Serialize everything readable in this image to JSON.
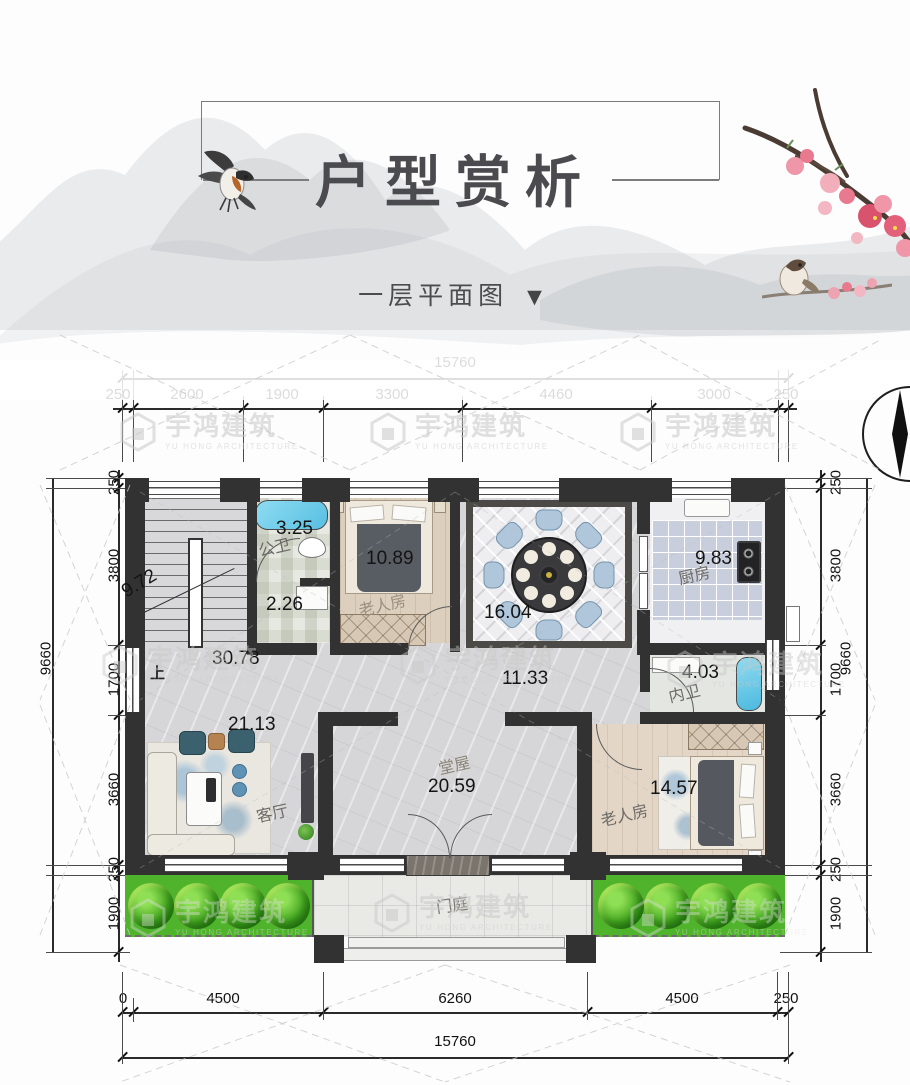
{
  "header": {
    "title": "户型赏析",
    "subtitle": "一层平面图",
    "arrow": "▼"
  },
  "watermark": {
    "cn": "宇鸿建筑",
    "en": "YU HONG ARCHITECTURE"
  },
  "palette": {
    "wall": "#323232",
    "grass": "#4fb42c",
    "water": "#6fcbe8",
    "wood": "#dccfbd",
    "chair_blue": "#b0c6da",
    "blossom_pink": "#e87e95"
  },
  "dims": {
    "top_total": "15760",
    "top_segments": [
      "250",
      "2600",
      "1900",
      "3300",
      "4460",
      "3000",
      "250"
    ],
    "left_total": "9660",
    "left_segments": [
      "250",
      "3800",
      "1700",
      "3660",
      "250",
      "1900"
    ],
    "right_total": "9660",
    "right_segments": [
      "250",
      "3800",
      "1700",
      "3660",
      "250",
      "1900"
    ],
    "bottom_segments": [
      "0",
      "4500",
      "6260",
      "4500",
      "250"
    ],
    "bottom_total": "15760"
  },
  "rooms": {
    "stairs": {
      "area": "9.72",
      "up": "上"
    },
    "bath1": {
      "name": "公卫",
      "area": "3.25"
    },
    "lobby": {
      "area": "2.26"
    },
    "bed_top": {
      "name": "老人房",
      "area": "10.89"
    },
    "dining": {
      "area": "16.04"
    },
    "kitchen": {
      "name": "厨房",
      "area": "9.83"
    },
    "hall_west": {
      "area": "30.78"
    },
    "hall_mid": {
      "area": "11.33"
    },
    "bath2": {
      "name": "内卫",
      "area": "4.03"
    },
    "living": {
      "name": "客厅",
      "area": "21.13"
    },
    "main_hall": {
      "name": "堂屋",
      "area": "20.59"
    },
    "bed_bottom": {
      "name": "老人房",
      "area": "14.57"
    },
    "porch": {
      "name": "门庭"
    }
  }
}
